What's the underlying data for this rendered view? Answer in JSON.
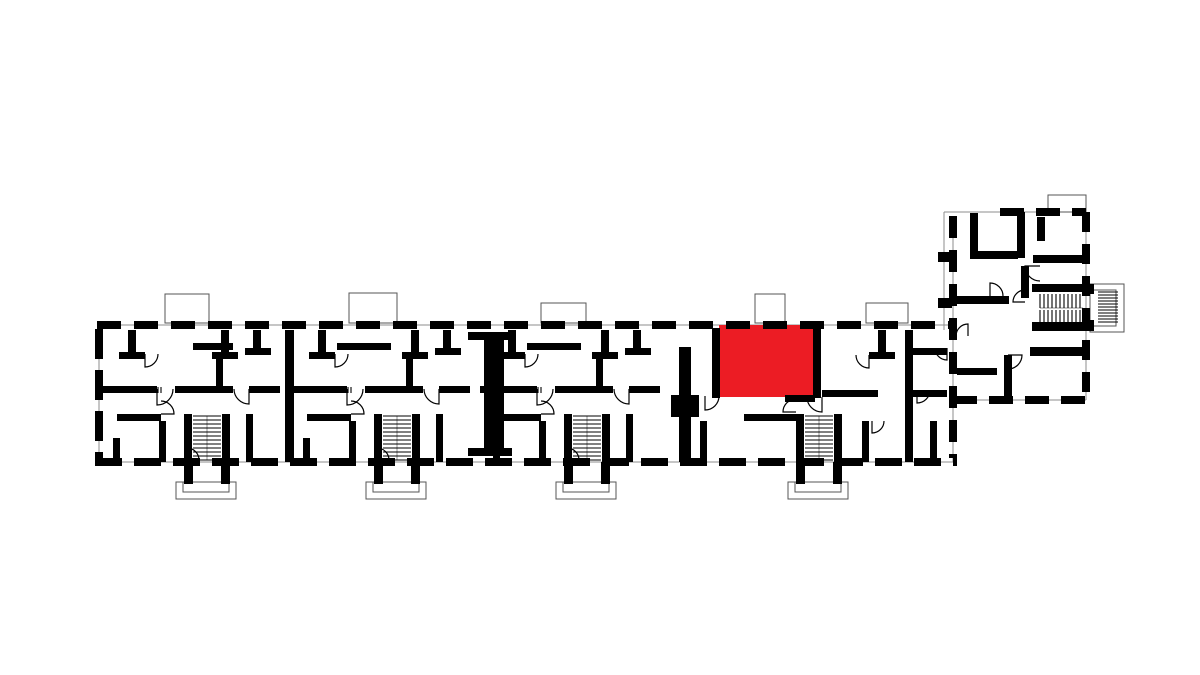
{
  "meta": {
    "canvas": {
      "width": 1200,
      "height": 675
    },
    "colors": {
      "background": "#ffffff",
      "wall": "#000000",
      "thin_line": "#8c8c8c",
      "highlight": "#EC1C24"
    }
  },
  "plan": {
    "highlight_unit": {
      "x": 719,
      "y": 325,
      "w": 94,
      "h": 72
    },
    "thin_lines": [
      [
        97,
        325,
        957,
        325
      ],
      [
        95,
        462,
        957,
        462
      ],
      [
        944,
        212,
        1086,
        212
      ],
      [
        1086,
        212,
        1086,
        400
      ],
      [
        953,
        400,
        1086,
        400
      ],
      [
        953,
        216,
        953,
        462
      ],
      [
        99,
        329,
        99,
        458
      ],
      [
        944,
        212,
        944,
        330
      ],
      [
        207,
        416,
        207,
        460
      ],
      [
        397,
        416,
        397,
        460
      ],
      [
        587,
        416,
        587,
        460
      ],
      [
        819,
        416,
        819,
        460
      ],
      [
        1040,
        308,
        1083,
        308
      ]
    ],
    "thin_rects": [
      {
        "r": [
          165,
          294,
          44,
          29
        ],
        "n": "balcony-outline"
      },
      {
        "r": [
          349,
          293,
          48,
          30
        ],
        "n": "balcony-outline"
      },
      {
        "r": [
          541,
          303,
          45,
          20
        ],
        "n": "balcony-outline"
      },
      {
        "r": [
          755,
          294,
          30,
          29
        ],
        "n": "balcony-outline"
      },
      {
        "r": [
          866,
          303,
          42,
          20
        ],
        "n": "balcony-outline"
      },
      {
        "r": [
          1048,
          195,
          38,
          17
        ],
        "n": "balcony-outline"
      },
      {
        "r": [
          176,
          482,
          60,
          17
        ],
        "n": "entrance-porch-outline"
      },
      {
        "r": [
          183,
          482,
          46,
          10
        ],
        "n": "entrance-porch-outline"
      },
      {
        "r": [
          366,
          482,
          60,
          17
        ],
        "n": "entrance-porch-outline"
      },
      {
        "r": [
          373,
          482,
          46,
          10
        ],
        "n": "entrance-porch-outline"
      },
      {
        "r": [
          556,
          482,
          60,
          17
        ],
        "n": "entrance-porch-outline"
      },
      {
        "r": [
          563,
          482,
          46,
          10
        ],
        "n": "entrance-porch-outline"
      },
      {
        "r": [
          788,
          482,
          60,
          17
        ],
        "n": "entrance-porch-outline"
      },
      {
        "r": [
          795,
          482,
          46,
          10
        ],
        "n": "entrance-porch-outline"
      },
      {
        "r": [
          1090,
          284,
          34,
          48
        ],
        "n": "stair-landing-outline"
      },
      {
        "r": [
          1090,
          290,
          26,
          36
        ],
        "n": "stair-landing-outline"
      }
    ],
    "walls": [
      [
        128,
        330,
        8,
        26
      ],
      [
        119,
        352,
        26,
        7
      ],
      [
        221,
        330,
        8,
        26
      ],
      [
        212,
        352,
        26,
        7
      ],
      [
        216,
        357,
        7,
        29
      ],
      [
        193,
        343,
        40,
        7
      ],
      [
        253,
        330,
        8,
        22
      ],
      [
        245,
        348,
        26,
        7
      ],
      [
        100,
        386,
        57,
        7
      ],
      [
        175,
        386,
        58,
        7
      ],
      [
        249,
        386,
        31,
        7
      ],
      [
        117,
        414,
        44,
        7
      ],
      [
        159,
        421,
        7,
        41
      ],
      [
        246,
        414,
        7,
        48
      ],
      [
        113,
        438,
        7,
        24
      ],
      [
        184,
        414,
        8,
        48
      ],
      [
        222,
        414,
        8,
        48
      ],
      [
        184,
        462,
        9,
        22
      ],
      [
        221,
        462,
        9,
        22
      ],
      [
        318,
        330,
        8,
        26
      ],
      [
        309,
        352,
        26,
        7
      ],
      [
        411,
        330,
        8,
        26
      ],
      [
        402,
        352,
        26,
        7
      ],
      [
        406,
        357,
        7,
        29
      ],
      [
        337,
        343,
        54,
        7
      ],
      [
        443,
        330,
        8,
        22
      ],
      [
        435,
        348,
        26,
        7
      ],
      [
        290,
        386,
        57,
        7
      ],
      [
        365,
        386,
        58,
        7
      ],
      [
        439,
        386,
        31,
        7
      ],
      [
        307,
        414,
        44,
        7
      ],
      [
        349,
        421,
        7,
        41
      ],
      [
        436,
        414,
        7,
        48
      ],
      [
        303,
        438,
        7,
        24
      ],
      [
        374,
        414,
        8,
        48
      ],
      [
        412,
        414,
        8,
        48
      ],
      [
        374,
        462,
        9,
        22
      ],
      [
        411,
        462,
        9,
        22
      ],
      [
        508,
        330,
        8,
        26
      ],
      [
        499,
        352,
        26,
        7
      ],
      [
        601,
        330,
        8,
        26
      ],
      [
        592,
        352,
        26,
        7
      ],
      [
        596,
        357,
        7,
        29
      ],
      [
        527,
        343,
        54,
        7
      ],
      [
        633,
        330,
        8,
        22
      ],
      [
        625,
        348,
        26,
        7
      ],
      [
        480,
        386,
        57,
        7
      ],
      [
        555,
        386,
        58,
        7
      ],
      [
        629,
        386,
        31,
        7
      ],
      [
        497,
        414,
        44,
        7
      ],
      [
        539,
        421,
        7,
        41
      ],
      [
        626,
        414,
        7,
        48
      ],
      [
        493,
        438,
        7,
        24
      ],
      [
        564,
        414,
        8,
        48
      ],
      [
        602,
        414,
        8,
        48
      ],
      [
        564,
        462,
        9,
        22
      ],
      [
        601,
        462,
        9,
        22
      ],
      [
        285,
        330,
        9,
        132
      ],
      [
        468,
        332,
        44,
        8
      ],
      [
        484,
        334,
        20,
        122
      ],
      [
        468,
        448,
        44,
        8
      ],
      [
        679,
        347,
        12,
        115
      ],
      [
        671,
        395,
        28,
        22
      ],
      [
        905,
        330,
        8,
        132
      ],
      [
        712,
        328,
        8,
        70
      ],
      [
        813,
        328,
        8,
        70
      ],
      [
        785,
        395,
        30,
        7
      ],
      [
        822,
        390,
        56,
        7
      ],
      [
        878,
        330,
        8,
        26
      ],
      [
        869,
        352,
        26,
        7
      ],
      [
        862,
        421,
        7,
        41
      ],
      [
        744,
        414,
        52,
        7
      ],
      [
        700,
        421,
        7,
        41
      ],
      [
        796,
        414,
        8,
        48
      ],
      [
        834,
        414,
        8,
        48
      ],
      [
        796,
        462,
        9,
        22
      ],
      [
        833,
        462,
        9,
        22
      ],
      [
        913,
        348,
        34,
        7
      ],
      [
        913,
        390,
        34,
        7
      ],
      [
        930,
        421,
        7,
        41
      ],
      [
        970,
        213,
        8,
        44
      ],
      [
        970,
        251,
        48,
        8
      ],
      [
        1017,
        212,
        8,
        46
      ],
      [
        1037,
        217,
        8,
        24
      ],
      [
        1033,
        255,
        53,
        8
      ],
      [
        957,
        296,
        52,
        8
      ],
      [
        1021,
        266,
        8,
        32
      ],
      [
        1032,
        284,
        52,
        8
      ],
      [
        1032,
        322,
        52,
        9
      ],
      [
        1030,
        347,
        58,
        9
      ],
      [
        1004,
        355,
        8,
        45
      ],
      [
        1083,
        284,
        11,
        10
      ],
      [
        1083,
        320,
        11,
        11
      ],
      [
        957,
        368,
        40,
        7
      ],
      [
        938,
        252,
        14,
        10
      ],
      [
        938,
        298,
        14,
        10
      ]
    ],
    "exterior_walls": [
      {
        "l": [
          97,
          325,
          957,
          325
        ],
        "dash": "24 13"
      },
      {
        "l": [
          95,
          462,
          957,
          462
        ],
        "dash": "27 12"
      },
      {
        "l": [
          99,
          329,
          99,
          458
        ],
        "dash": "30 11"
      },
      {
        "l": [
          953,
          216,
          953,
          458
        ],
        "dash": "22 12"
      },
      {
        "l": [
          1000,
          212,
          1086,
          212
        ],
        "dash": "24 12"
      },
      {
        "l": [
          1086,
          212,
          1086,
          400
        ],
        "dash": "20 12"
      },
      {
        "l": [
          953,
          400,
          1086,
          400
        ],
        "dash": "24 12"
      }
    ],
    "hatches": [
      {
        "r": [
          193,
          416,
          28,
          44
        ],
        "o": "h",
        "g": 4,
        "n": "stair-hatch"
      },
      {
        "r": [
          383,
          416,
          28,
          44
        ],
        "o": "h",
        "g": 4,
        "n": "stair-hatch"
      },
      {
        "r": [
          573,
          416,
          28,
          44
        ],
        "o": "h",
        "g": 4,
        "n": "stair-hatch"
      },
      {
        "r": [
          805,
          416,
          28,
          44
        ],
        "o": "h",
        "g": 4,
        "n": "stair-hatch"
      },
      {
        "r": [
          146,
          387,
          17,
          6
        ],
        "o": "v",
        "g": 3,
        "n": "door-threshold-hatch"
      },
      {
        "r": [
          336,
          387,
          17,
          6
        ],
        "o": "v",
        "g": 3,
        "n": "door-threshold-hatch"
      },
      {
        "r": [
          526,
          387,
          17,
          6
        ],
        "o": "v",
        "g": 3,
        "n": "door-threshold-hatch"
      },
      {
        "r": [
          1040,
          294,
          43,
          14
        ],
        "o": "v",
        "g": 4,
        "n": "stair-hatch"
      },
      {
        "r": [
          1040,
          310,
          43,
          12
        ],
        "o": "v",
        "g": 4,
        "n": "stair-hatch"
      },
      {
        "r": [
          1098,
          292,
          20,
          32
        ],
        "o": "h",
        "g": 3,
        "n": "stair-hatch"
      }
    ],
    "door_arcs": [
      {
        "h": [
          157,
          389
        ],
        "r": 16,
        "d1": [
          0,
          1
        ],
        "d2": [
          1,
          0
        ],
        "s": 0
      },
      {
        "h": [
          347,
          389
        ],
        "r": 16,
        "d1": [
          0,
          1
        ],
        "d2": [
          1,
          0
        ],
        "s": 0
      },
      {
        "h": [
          537,
          389
        ],
        "r": 16,
        "d1": [
          0,
          1
        ],
        "d2": [
          1,
          0
        ],
        "s": 0
      },
      {
        "h": [
          249,
          389
        ],
        "r": 15,
        "d1": [
          0,
          1
        ],
        "d2": [
          -1,
          0
        ],
        "s": 1
      },
      {
        "h": [
          439,
          389
        ],
        "r": 15,
        "d1": [
          0,
          1
        ],
        "d2": [
          -1,
          0
        ],
        "s": 1
      },
      {
        "h": [
          629,
          389
        ],
        "r": 15,
        "d1": [
          0,
          1
        ],
        "d2": [
          -1,
          0
        ],
        "s": 1
      },
      {
        "h": [
          161,
          414
        ],
        "r": 13,
        "d1": [
          1,
          0
        ],
        "d2": [
          0,
          -1
        ],
        "s": 0
      },
      {
        "h": [
          351,
          414
        ],
        "r": 13,
        "d1": [
          1,
          0
        ],
        "d2": [
          0,
          -1
        ],
        "s": 0
      },
      {
        "h": [
          541,
          414
        ],
        "r": 13,
        "d1": [
          1,
          0
        ],
        "d2": [
          0,
          -1
        ],
        "s": 0
      },
      {
        "h": [
          187,
          460
        ],
        "r": 12,
        "d1": [
          1,
          0
        ],
        "d2": [
          0,
          -1
        ],
        "s": 0
      },
      {
        "h": [
          377,
          460
        ],
        "r": 12,
        "d1": [
          1,
          0
        ],
        "d2": [
          0,
          -1
        ],
        "s": 0
      },
      {
        "h": [
          567,
          460
        ],
        "r": 12,
        "d1": [
          1,
          0
        ],
        "d2": [
          0,
          -1
        ],
        "s": 0
      },
      {
        "h": [
          145,
          354
        ],
        "r": 13,
        "d1": [
          0,
          1
        ],
        "d2": [
          1,
          0
        ],
        "s": 0
      },
      {
        "h": [
          335,
          354
        ],
        "r": 13,
        "d1": [
          0,
          1
        ],
        "d2": [
          1,
          0
        ],
        "s": 0
      },
      {
        "h": [
          525,
          354
        ],
        "r": 13,
        "d1": [
          0,
          1
        ],
        "d2": [
          1,
          0
        ],
        "s": 0
      },
      {
        "h": [
          705,
          396
        ],
        "r": 14,
        "d1": [
          0,
          1
        ],
        "d2": [
          1,
          0
        ],
        "s": 0
      },
      {
        "h": [
          796,
          412
        ],
        "r": 13,
        "d1": [
          -1,
          0
        ],
        "d2": [
          0,
          -1
        ],
        "s": 1
      },
      {
        "h": [
          822,
          397
        ],
        "r": 15,
        "d1": [
          0,
          1
        ],
        "d2": [
          -1,
          0
        ],
        "s": 1
      },
      {
        "h": [
          872,
          421
        ],
        "r": 12,
        "d1": [
          0,
          1
        ],
        "d2": [
          1,
          0
        ],
        "s": 0
      },
      {
        "h": [
          869,
          355
        ],
        "r": 13,
        "d1": [
          0,
          1
        ],
        "d2": [
          -1,
          0
        ],
        "s": 1
      },
      {
        "h": [
          917,
          390
        ],
        "r": 13,
        "d1": [
          0,
          1
        ],
        "d2": [
          1,
          0
        ],
        "s": 0
      },
      {
        "h": [
          947,
          348
        ],
        "r": 12,
        "d1": [
          0,
          1
        ],
        "d2": [
          -1,
          0
        ],
        "s": 1
      },
      {
        "h": [
          1040,
          266
        ],
        "r": 15,
        "d1": [
          -1,
          0
        ],
        "d2": [
          0,
          1
        ],
        "s": 0
      },
      {
        "h": [
          990,
          296
        ],
        "r": 13,
        "d1": [
          0,
          -1
        ],
        "d2": [
          1,
          0
        ],
        "s": 1
      },
      {
        "h": [
          1008,
          355
        ],
        "r": 14,
        "d1": [
          1,
          0
        ],
        "d2": [
          0,
          1
        ],
        "s": 1
      },
      {
        "h": [
          968,
          336
        ],
        "r": 12,
        "d1": [
          0,
          -1
        ],
        "d2": [
          -1,
          0
        ],
        "s": 0
      },
      {
        "h": [
          1025,
          302
        ],
        "r": 12,
        "d1": [
          -1,
          0
        ],
        "d2": [
          0,
          -1
        ],
        "s": 1
      }
    ]
  }
}
